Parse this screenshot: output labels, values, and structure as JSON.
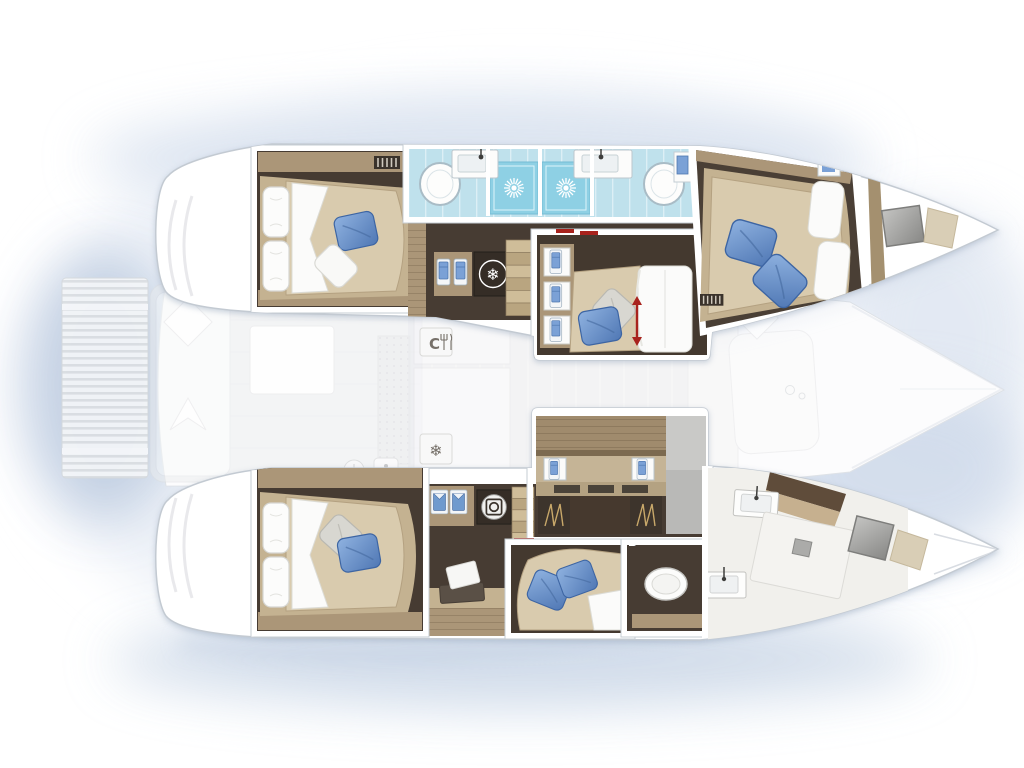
{
  "meta": {
    "title": "Catamaran yacht interior floor plan",
    "view": "top-down layout, bow pointing right, stern left",
    "decks": "lower-deck hull cabins drawn vivid; main deck (cockpit, saloon, platform) drawn faded gray"
  },
  "glyphs": {
    "galley_letter": "C",
    "snowflake": "❄"
  },
  "icons": {
    "sun": "white starburst on shower tile",
    "snowflake": "refrigeration symbol",
    "galley": "letter C with fork and knife",
    "washing_machine": "white circle with drum",
    "bed_extend_arrow": "red vertical double arrow",
    "vent": "slatted grille"
  },
  "colors": {
    "background": "#ffffff",
    "glow_blue": "#d8e1ee",
    "hull_white": "#ffffff",
    "deck_faded_gray": "#ebecee",
    "floor_dark_wood": "#473c33",
    "wood_trim": "#ab9678",
    "wood_light": "#c4b291",
    "mattress_tan": "#d9cbae",
    "linen_white": "#fbfbfa",
    "pillow_blue": "#6f9ace",
    "pillow_gray": "#d8d7d1",
    "bathroom_floor_blue": "#bfe1ec",
    "shower_floor_blue": "#8ed0e4",
    "marble_white": "#f1f0ec",
    "hatch_gray": "#9c9c9a",
    "accent_red": "#a8231d"
  },
  "areas": {
    "port_hull": [
      {
        "name": "aft-cabin",
        "features": [
          "double bed",
          "two white head pillows",
          "blue pillow",
          "white throw pillow",
          "vent grille"
        ]
      },
      {
        "name": "bathroom",
        "features": [
          "two sinks with faucets",
          "two oval shower trays",
          "two blue shower tiles with sun symbol",
          "towel panel"
        ]
      },
      {
        "name": "companionway",
        "features": [
          "stairs",
          "towel locker",
          "snowflake cooler"
        ]
      },
      {
        "name": "mid-cabin",
        "features": [
          "sliding bed with red extend arrow",
          "gray pillow",
          "blue pillow",
          "shelf niches with towels"
        ]
      },
      {
        "name": "fore-cabin",
        "features": [
          "double bed",
          "two blue pillows",
          "white duvet panels",
          "vent grille"
        ]
      },
      {
        "name": "bow",
        "features": [
          "gray hatch",
          "beige pad"
        ]
      }
    ],
    "starboard_hull": [
      {
        "name": "aft-cabin",
        "features": [
          "double bed",
          "two white head pillows",
          "gray pillow",
          "blue pillow",
          "desk with laptop",
          "two vent grilles"
        ]
      },
      {
        "name": "companionway",
        "features": [
          "stairs",
          "shirt lockers",
          "washing machine"
        ]
      },
      {
        "name": "dressing-wardrobe",
        "features": [
          "wood cabinet",
          "two towel niches",
          "shelf slots",
          "two hanging lockers",
          "gray panels"
        ]
      },
      {
        "name": "mid-berth",
        "features": [
          "chaise bed",
          "two blue pillows",
          "white duvet corner"
        ]
      },
      {
        "name": "bathroom",
        "features": [
          "toilet",
          "two sinks",
          "tilted shower with drain"
        ]
      },
      {
        "name": "bow",
        "features": [
          "gray hatch",
          "beige pad"
        ]
      }
    ],
    "deck_faded": [
      {
        "name": "aft-platform",
        "features": [
          "slatted floor"
        ]
      },
      {
        "name": "cockpit",
        "features": [
          "bench with diamond cushions",
          "table",
          "dotted mat",
          "burner and sink tiles"
        ]
      },
      {
        "name": "saloon-galley",
        "features": [
          "counters",
          "galley C tile",
          "snowflake tile"
        ]
      },
      {
        "name": "foredeck",
        "features": [
          "lounge pad",
          "diamond cushion",
          "bow rigging lines"
        ]
      }
    ]
  }
}
